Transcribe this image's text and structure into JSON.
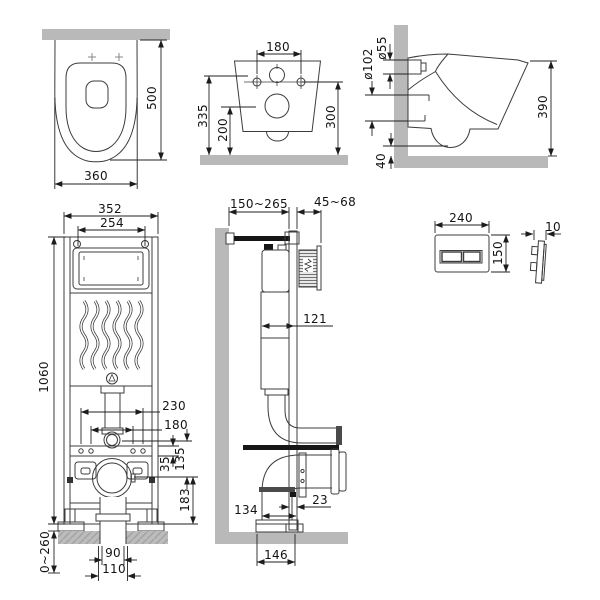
{
  "views": {
    "toilet_top": {
      "dims": {
        "depth": "500",
        "width": "360"
      }
    },
    "toilet_rear": {
      "dims": {
        "bolt_spacing": "180",
        "height_overall": "335",
        "outlet_center_height": "200",
        "mount_height": "300"
      }
    },
    "toilet_side": {
      "dims": {
        "inlet_diameter": "ø55",
        "outlet_diameter": "ø102",
        "height": "390",
        "floor_clearance": "40"
      }
    },
    "frame_front": {
      "dims": {
        "frame_width": "352",
        "panel_width": "254",
        "frame_height": "1060",
        "bracket_span_outer": "230",
        "bracket_span_inner": "180",
        "inlet_to_outlet": "135",
        "crossbar_height": "35",
        "outlet_to_bottom": "183",
        "outlet_pipe_width": "90",
        "outlet_socket_width": "110",
        "foot_adjust_range": "0~260"
      }
    },
    "frame_side": {
      "dims": {
        "frame_depth_range": "150~265",
        "finish_depth_range": "45~68",
        "cistern_depth": "121",
        "frame_post_depth": "23",
        "outlet_depth": "134",
        "base_depth": "146"
      }
    },
    "flush_plate": {
      "dims": {
        "width": "240",
        "height": "150",
        "thickness": "10"
      }
    },
    "colors": {
      "line": "#3c3c3c",
      "dimension": "#222222",
      "masonry": "#b9b9b9",
      "black_part": "#161616"
    }
  }
}
